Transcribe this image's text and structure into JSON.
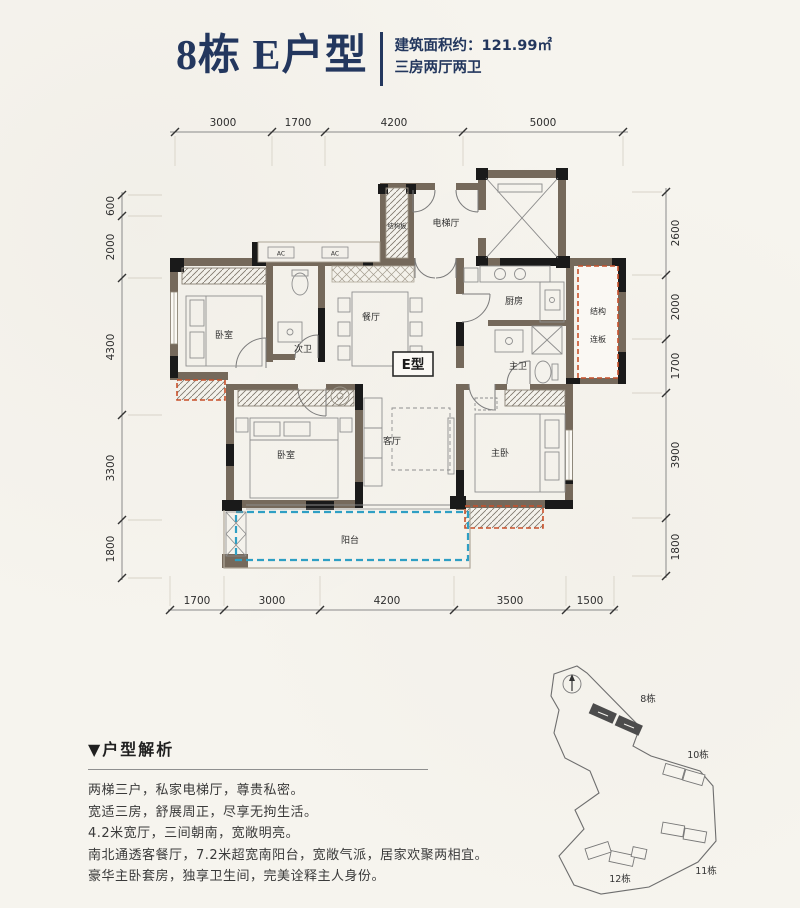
{
  "header": {
    "title": "8栋 E户型",
    "area_label": "建筑面积约：121.99㎡",
    "layout_label": "三房两厅两卫"
  },
  "floorplan": {
    "unit_tag": "E型",
    "rooms": {
      "bedroom1": "卧室",
      "bath2": "次卫",
      "dining": "餐厅",
      "elevator_hall": "电梯厅",
      "structure_board": "结构板",
      "kitchen": "厨房",
      "master_bath": "主卫",
      "living": "客厅",
      "bedroom2": "卧室",
      "master_bedroom": "主卧",
      "balcony": "阳台",
      "structure_panel_line1": "结构",
      "structure_panel_line2": "连板",
      "ac_unit": "AC"
    },
    "dimensions": {
      "top": [
        "3000",
        "1700",
        "4200",
        "5000"
      ],
      "left": [
        "600",
        "2000",
        "4300",
        "3300",
        "1800"
      ],
      "right": [
        "2600",
        "2000",
        "1700",
        "3900",
        "1800"
      ],
      "bottom": [
        "1700",
        "3000",
        "4200",
        "3500",
        "1500"
      ]
    }
  },
  "analysis": {
    "header": "▼户型解析",
    "lines": [
      "两梯三户，私家电梯厅，尊贵私密。",
      "宽适三房，舒展周正，尽享无拘生活。",
      "4.2米宽厅，三间朝南，宽敞明亮。",
      "南北通透客餐厅，7.2米超宽南阳台，宽敞气派，居家欢聚两相宜。",
      "豪华主卧套房，独享卫生间，完美诠释主人身份。"
    ]
  },
  "siteplan": {
    "buildings": [
      "8栋",
      "10栋",
      "11栋",
      "12栋"
    ]
  },
  "colors": {
    "title_navy": "#23375e",
    "wall_brown": "#75695b",
    "column_black": "#1a1a1a",
    "balcony_blue": "#2e9fc4",
    "structure_red": "#c8502a"
  }
}
